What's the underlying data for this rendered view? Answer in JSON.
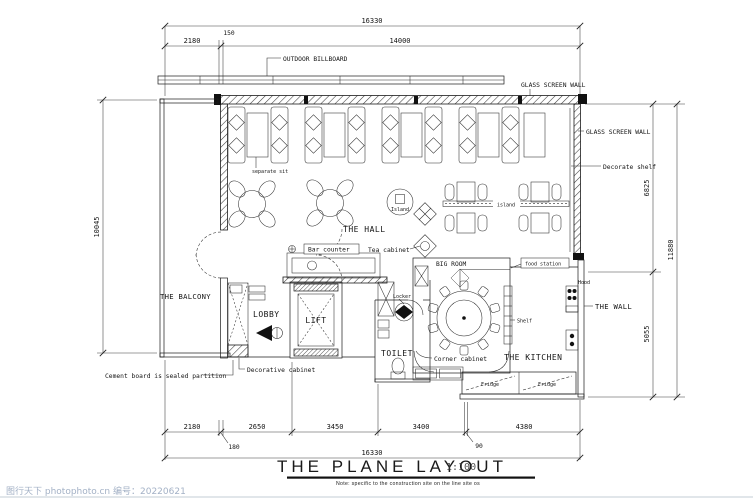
{
  "drawing": {
    "title": "THE PLANE LAYOUT",
    "scale": "1:100",
    "note": "Note: specific to the construction site on the line site os",
    "watermark": "图行天下 photophoto.cn 编号：20220621"
  },
  "dims": {
    "top_total": "16330",
    "top_left": "2180",
    "top_small": "150",
    "top_main": "14000",
    "bottom_1": "2180",
    "bottom_1s": "180",
    "bottom_2": "2650",
    "bottom_3": "3450",
    "bottom_4": "3400",
    "bottom_4s": "90",
    "bottom_5": "4380",
    "bottom_total": "16330",
    "left_total": "10045",
    "right_upper": "6825",
    "right_lower": "5055",
    "right_total": "11880"
  },
  "rooms": {
    "hall": "THE HALL",
    "balcony": "THE BALCONY",
    "lobby": "LOBBY",
    "lift": "LIFT",
    "toilet": "TOILET",
    "kitchen": "THE KITCHEN",
    "big_room": "BIG ROOM"
  },
  "callouts": {
    "outdoor_billboard": "OUTDOOR BILLBOARD",
    "glass_screen_wall_top": "GLASS SCREEN WALL",
    "glass_screen_wall_right": "GLASS SCREEN WALL",
    "decorate_shelf": "Decorate shelf",
    "separate_sit": "separate sit",
    "island_circle": "Island",
    "island_divider": "island",
    "bar_counter": "Bar counter",
    "tea_cabinet": "Tea cabinet",
    "food_station": "food station",
    "locker": "Locker",
    "shelf": "Shelf",
    "the_wall": "THE WALL",
    "hood": "Hood",
    "corner_cabinet": "Corner cabinet",
    "decorative_cabinet": "Decorative cabinet",
    "cement_board": "Cement board is sealed partition",
    "fridge_left": "Fridge",
    "fridge_right": "Fridge"
  }
}
